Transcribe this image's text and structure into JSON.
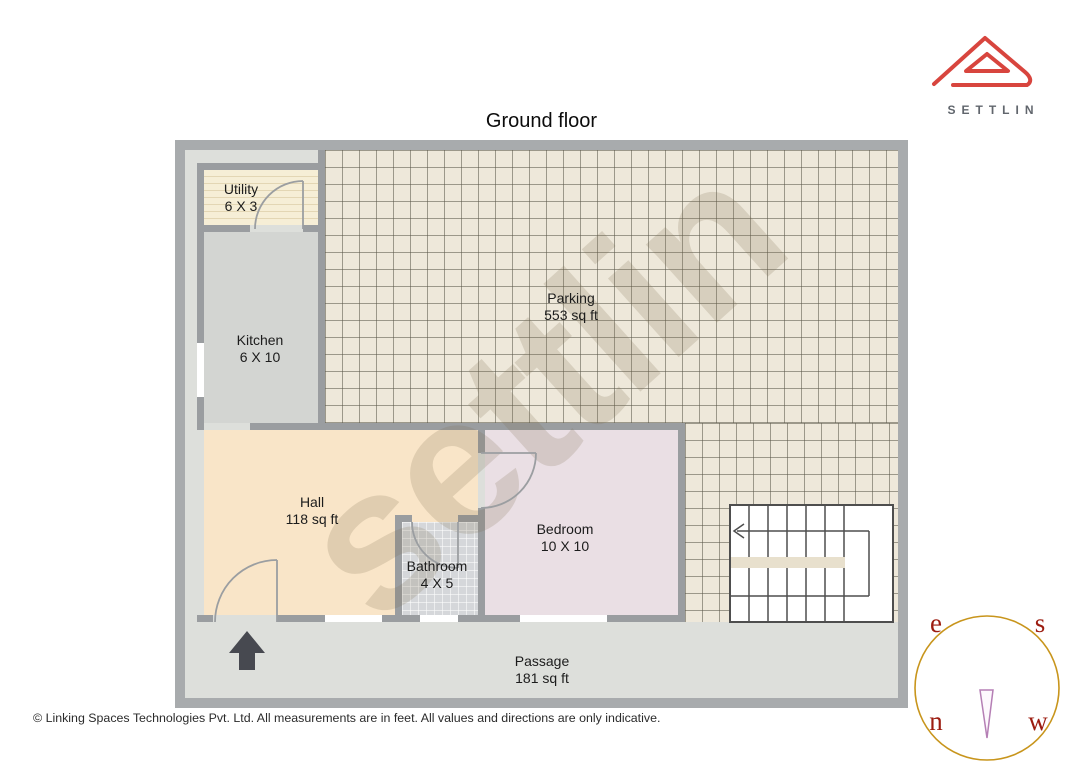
{
  "title": "Ground floor",
  "brand": {
    "name": "SETTLIN"
  },
  "watermark": "settlin",
  "rooms": {
    "utility": {
      "name": "Utility",
      "dims": "6 X 3"
    },
    "kitchen": {
      "name": "Kitchen",
      "dims": "6 X 10"
    },
    "parking": {
      "name": "Parking",
      "dims": "553 sq ft"
    },
    "hall": {
      "name": "Hall",
      "dims": "118 sq ft"
    },
    "bathroom": {
      "name": "Bathroom",
      "dims": "4 X 5"
    },
    "bedroom": {
      "name": "Bedroom",
      "dims": "10 X 10"
    },
    "passage": {
      "name": "Passage",
      "dims": "181 sq ft"
    }
  },
  "compass": {
    "letters": {
      "top_left": "e",
      "top_right": "s",
      "bottom_left": "n",
      "bottom_right": "w"
    }
  },
  "footer": {
    "text": "© Linking Spaces Technologies Pvt. Ltd. All measurements are in feet. All values and directions are only indicative."
  },
  "colors": {
    "brand_red": "#d8453e",
    "compass_ring": "#c8951c",
    "compass_letter": "#9c1c10",
    "needle_purple": "#b57fb5",
    "wall_gray": "#9a9da0"
  }
}
